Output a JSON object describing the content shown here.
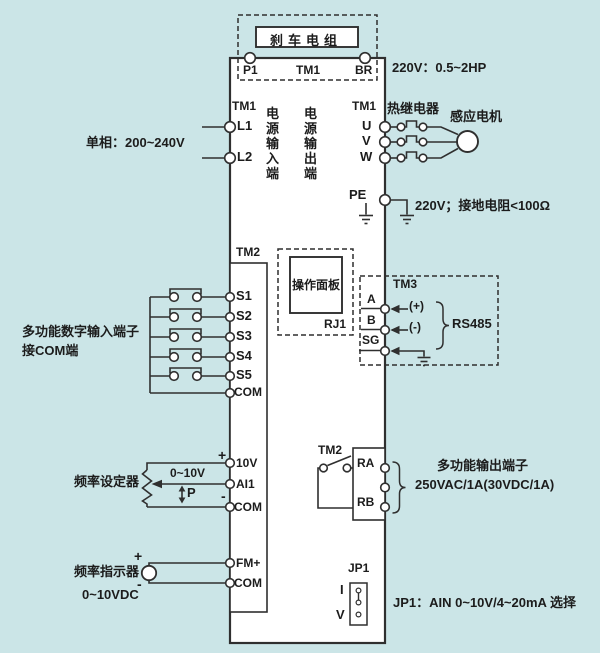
{
  "colors": {
    "background": "#cbe5e7",
    "line": "#2f2f2f",
    "box_fill": "#ffffff"
  },
  "brake": {
    "box_label": "刹车电组",
    "p1": "P1",
    "tm1": "TM1",
    "br": "BR",
    "rating": "220V：0.5~2HP"
  },
  "power_input": {
    "tm1": "TM1",
    "l1": "L1",
    "l2": "L2",
    "phase": "单相：200~240V",
    "group": "电源输入端"
  },
  "power_output": {
    "group": "电源输出端",
    "tm1": "TM1",
    "u": "U",
    "v": "V",
    "w": "W",
    "thermal_relay": "热继电器",
    "motor": "感应电机"
  },
  "grounding": {
    "pe": "PE",
    "note": "220V；接地电阻<100Ω"
  },
  "digital_input": {
    "tm2": "TM2",
    "terminals": [
      "S1",
      "S2",
      "S3",
      "S4",
      "S5",
      "COM"
    ],
    "note1": "多功能数字输入端子",
    "note2": "接COM端"
  },
  "operation_panel": {
    "label": "操作面板",
    "port": "RJ1"
  },
  "comm": {
    "tm3": "TM3",
    "a": "A",
    "b": "B",
    "sg": "SG",
    "plus": "(+)",
    "minus": "(-)",
    "bus": "RS485"
  },
  "freq_setter": {
    "label": "频率设定器",
    "range": "0~10V",
    "p": "P",
    "plus": "+",
    "minus": "-",
    "t10v": "10V",
    "ai1": "AI1",
    "com": "COM"
  },
  "relay_output": {
    "tm2": "TM2",
    "ra": "RA",
    "rb": "RB",
    "note1": "多功能输出端子",
    "note2": "250VAC/1A(30VDC/1A)"
  },
  "freq_indicator": {
    "label": "频率指示器",
    "range": "0~10VDC",
    "plus": "+",
    "minus": "-",
    "fm": "FM+",
    "com": "COM"
  },
  "jumper": {
    "label": "JP1",
    "i": "I",
    "v": "V",
    "note": "JP1：AIN  0~10V/4~20mA 选择"
  }
}
